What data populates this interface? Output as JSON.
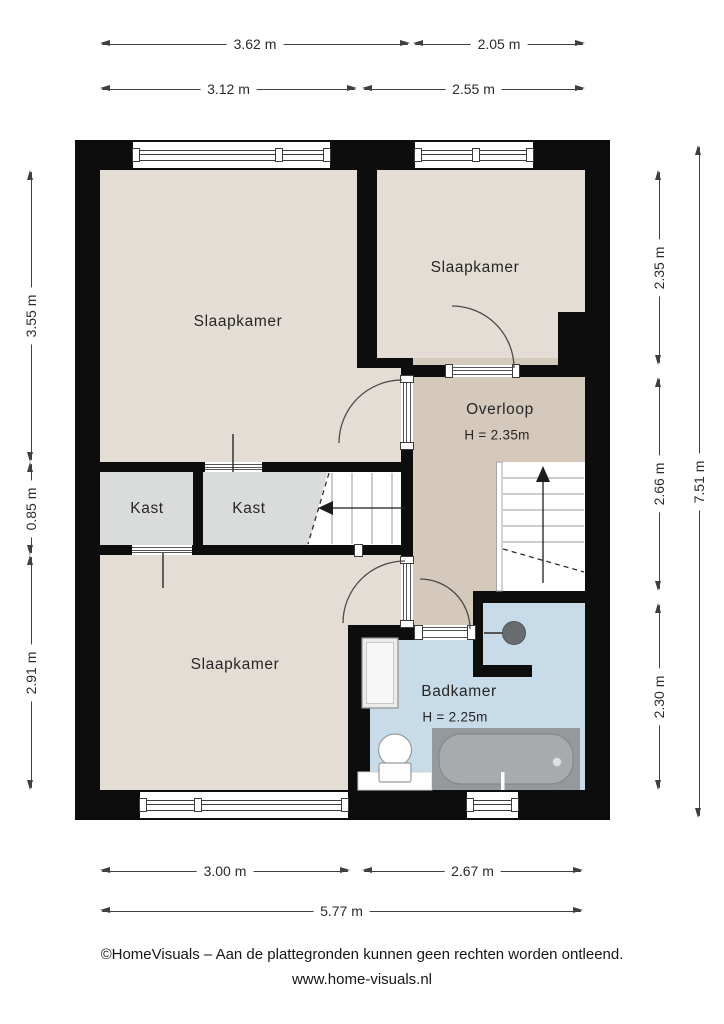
{
  "rooms": {
    "slaapkamer_tl": {
      "label": "Slaapkamer"
    },
    "slaapkamer_tr": {
      "label": "Slaapkamer"
    },
    "slaapkamer_b": {
      "label": "Slaapkamer"
    },
    "overloop": {
      "label": "Overloop",
      "height": "H = 2.35m"
    },
    "kast_1": {
      "label": "Kast"
    },
    "kast_2": {
      "label": "Kast"
    },
    "badkamer": {
      "label": "Badkamer",
      "height": "H = 2.25m"
    }
  },
  "dimensions": {
    "top_outer": [
      "3.62 m",
      "2.05 m"
    ],
    "top_inner": [
      "3.12 m",
      "2.55 m"
    ],
    "left": [
      "3.55 m",
      "0.85 m",
      "2.91 m"
    ],
    "right_inner": [
      "2.35 m",
      "2.66 m",
      "2.30 m"
    ],
    "right_outer": "7.51 m",
    "bottom_inner": [
      "3.00 m",
      "2.67 m"
    ],
    "bottom_outer": "5.77 m"
  },
  "footer": {
    "disclaimer": "©HomeVisuals – Aan de plattegronden kunnen geen rechten worden ontleend.",
    "website": "www.home-visuals.nl"
  },
  "colors": {
    "wall": "#0d0d0d",
    "bedroom_floor": "#e4ddd6",
    "hall_floor": "#d4c9ba",
    "closet_floor": "#dadcdb",
    "bathroom_floor": "#c8dbe8",
    "bathtub": "#95999c",
    "dimension_text": "#2b2b2b"
  }
}
